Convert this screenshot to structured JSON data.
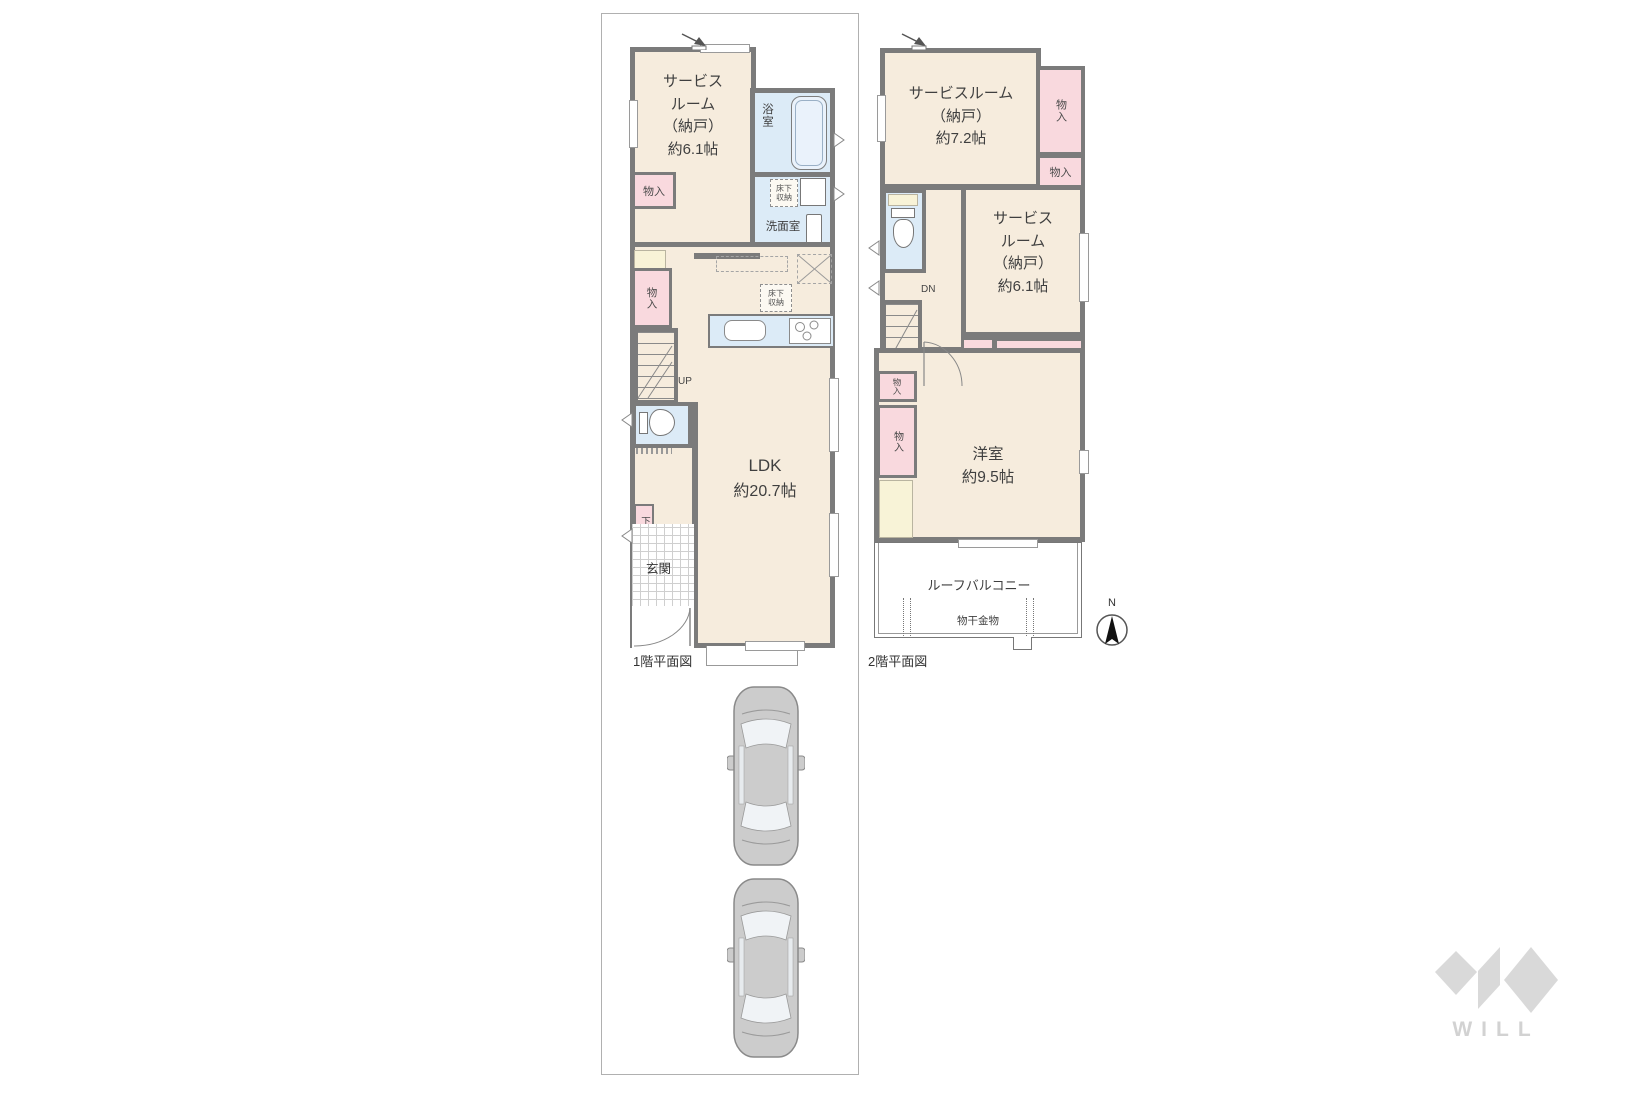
{
  "floor1": {
    "caption": "1階平面図",
    "service_room": [
      "サービス",
      "ルーム",
      "（納戸）",
      "約6.1帖"
    ],
    "bath": "浴室",
    "washroom": "洗面室",
    "underfloor_storage": [
      "床下",
      "収納"
    ],
    "closet": "物入",
    "shoe_closet": "下足入",
    "entrance": "玄関",
    "ldk": [
      "LDK",
      "約20.7帖"
    ],
    "stairs_up": "UP"
  },
  "floor2": {
    "caption": "2階平面図",
    "service_room_a": [
      "サービスルーム",
      "（納戸）",
      "約7.2帖"
    ],
    "service_room_b": [
      "サービス",
      "ルーム",
      "（納戸）",
      "約6.1帖"
    ],
    "western_room": [
      "洋室",
      "約9.5帖"
    ],
    "roof_balcony": "ルーフバルコニー",
    "laundry_hardware": "物干金物",
    "closet": "物入",
    "stairs_down": "DN"
  },
  "compass": {
    "north": "N"
  },
  "logo": {
    "text": "WILL"
  },
  "colors": {
    "room_floor": "#f6ecdd",
    "wet_area": "#dcebf7",
    "closet_pink": "#f9d9de",
    "pale_yellow": "#f8f3d7",
    "wall_gray": "#7b7b7b",
    "boundary_gray": "#b0b0b0",
    "car_body": "#cccccc",
    "logo_gray": "#d9d9d9"
  }
}
